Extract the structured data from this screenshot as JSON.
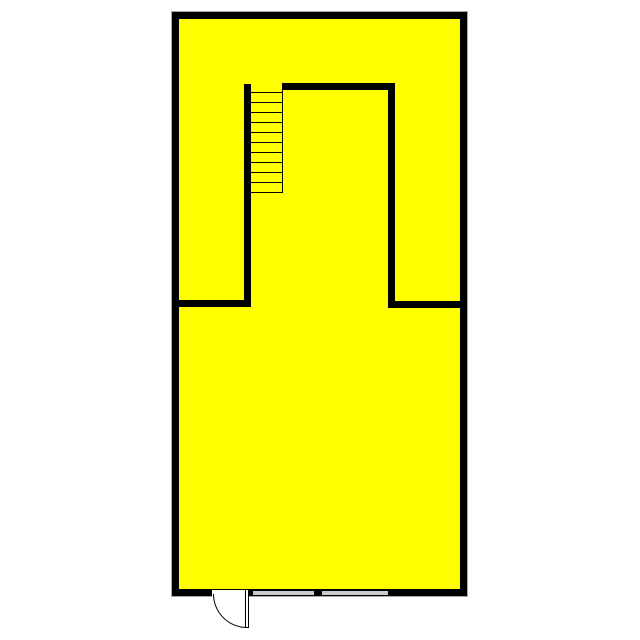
{
  "canvas": {
    "width": 640,
    "height": 640,
    "background": "#ffffff"
  },
  "plan": {
    "type": "floor-plan",
    "fill_color": "#ffff00",
    "wall_color": "#000000",
    "outline_color": "#a8a8a8",
    "window_color": "#c9c9c9",
    "door_color": "#ffffff",
    "outer": {
      "x": 172,
      "y": 12,
      "width": 295,
      "height": 584,
      "thickness": 7
    },
    "interior_walls": [
      {
        "name": "upper-room-left-wall",
        "x": 244,
        "y": 84,
        "width": 7,
        "height": 223
      },
      {
        "name": "upper-room-top-wall",
        "x": 282,
        "y": 83,
        "width": 113,
        "height": 7
      },
      {
        "name": "upper-room-right-wall",
        "x": 388,
        "y": 83,
        "width": 7,
        "height": 225
      },
      {
        "name": "mid-left-wall",
        "x": 172,
        "y": 300,
        "width": 79,
        "height": 7
      },
      {
        "name": "mid-right-wall",
        "x": 388,
        "y": 301,
        "width": 79,
        "height": 7
      }
    ],
    "stairs": {
      "x": 251,
      "y": 84,
      "width": 32,
      "height": 109.5,
      "tread_count": 11,
      "tread_start_y": 91.5,
      "tread_spacing": 10,
      "rail": {
        "x": 281.5,
        "y": 84,
        "width": 1.5,
        "height": 109
      }
    },
    "door": {
      "opening": {
        "x": 212,
        "y": 590,
        "width": 36,
        "height": 6.5
      },
      "leaf": {
        "x": 245,
        "y": 589,
        "width": 3.5,
        "height": 39
      },
      "arc": {
        "x": 212.5,
        "y": 594,
        "width": 34,
        "height": 34
      },
      "swing_radius": 34
    },
    "windows": [
      {
        "x": 253,
        "y": 590.5,
        "width": 60.5,
        "height": 4
      },
      {
        "x": 321.5,
        "y": 590.5,
        "width": 66.5,
        "height": 4
      }
    ]
  }
}
